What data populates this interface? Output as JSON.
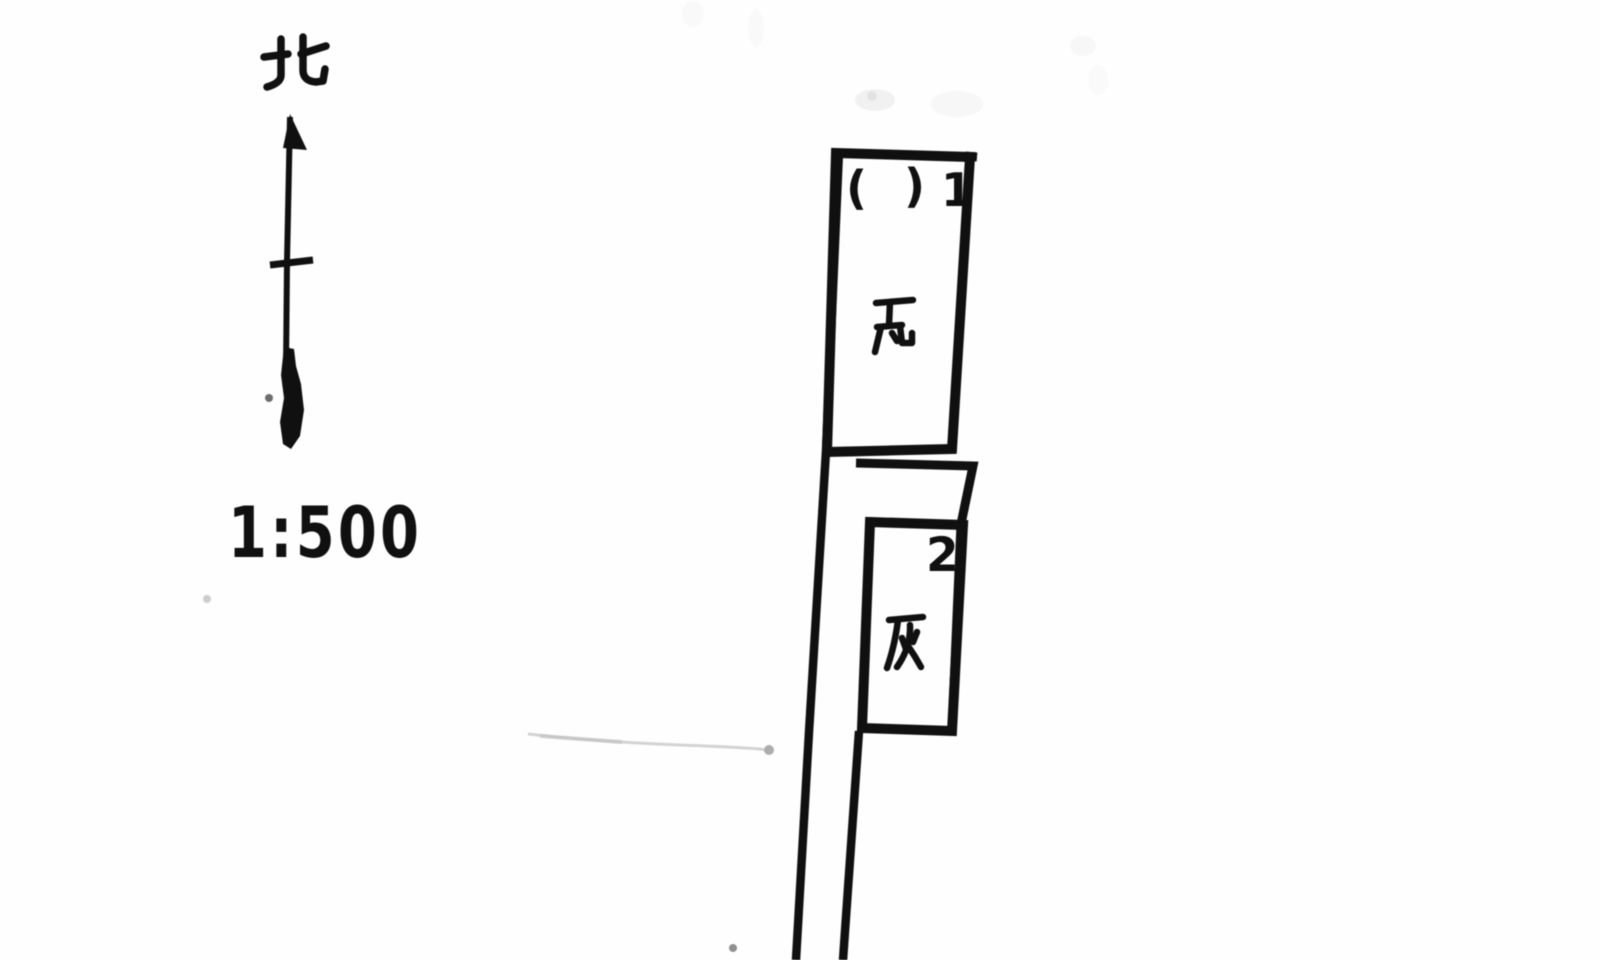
{
  "compass": {
    "north_label": "北"
  },
  "scale": {
    "text": "1:500"
  },
  "buildings": {
    "b1": {
      "paren_open": "(",
      "paren_close": ")",
      "number": "1",
      "material": "瓦"
    },
    "b2": {
      "number": "2",
      "material": "灰"
    }
  },
  "colors": {
    "ink": "#151515",
    "paper": "#fefefe",
    "faint_artifact": "#cfcfcf"
  }
}
